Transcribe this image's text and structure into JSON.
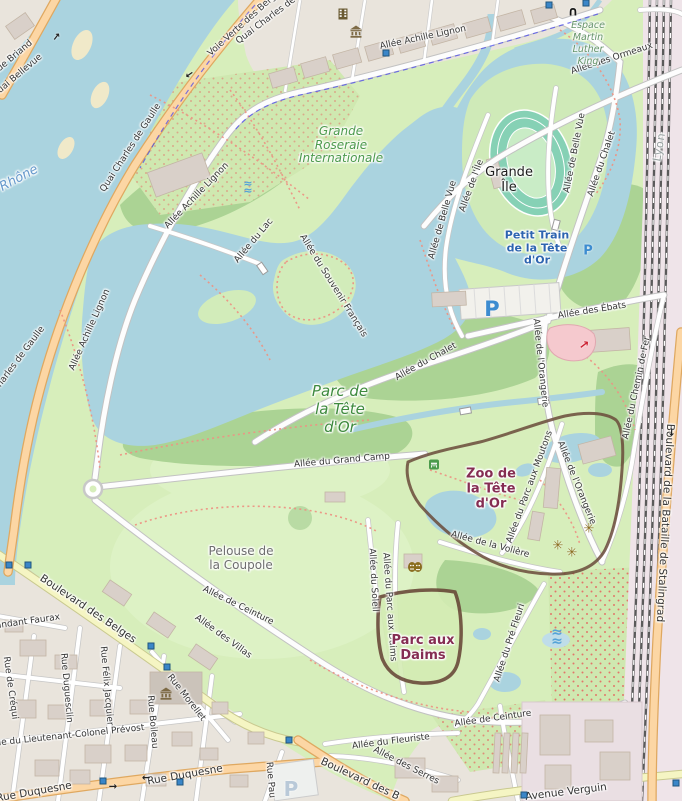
{
  "colors": {
    "water": "#aad3df",
    "park": "#d7eebb",
    "wood": "#abd394",
    "road_primary": "#fcd6a4",
    "road_secondary": "#f5f5c3",
    "urban": "#e9e4dc",
    "building": "#d9d0c9",
    "rail": "#5a5a5a",
    "zoo_border": "#6a4a3a",
    "label_green": "#4c9a4c",
    "label_maroon": "#852d52",
    "label_blue": "#2d64b0"
  },
  "labels": [
    {
      "id": "ide-briand",
      "text": "ide Briand",
      "x": 14,
      "y": 57,
      "rot": -40,
      "cls": "street"
    },
    {
      "id": "quai-bellevue",
      "text": "uai Bellevue",
      "x": 20,
      "y": 74,
      "rot": -40,
      "cls": "street"
    },
    {
      "id": "le-rhone",
      "text": "e Rhône",
      "x": 14,
      "y": 182,
      "rot": -28,
      "cls": "water-name"
    },
    {
      "id": "qcdg-top",
      "text": "Quai Charles de",
      "x": 266,
      "y": 21,
      "rot": -37,
      "cls": "street"
    },
    {
      "id": "voie-verte",
      "text": "Voie Verte des Berges",
      "x": 246,
      "y": 22,
      "rot": -42,
      "cls": "street"
    },
    {
      "id": "qcdg-mid",
      "text": "Quai Charles de Gaulle",
      "x": 131,
      "y": 148,
      "rot": -57,
      "cls": "street"
    },
    {
      "id": "qcdg-left",
      "text": "harles de Gaulle",
      "x": 21,
      "y": 357,
      "rot": -53,
      "cls": "street"
    },
    {
      "id": "aal-top",
      "text": "Allée Achille Lignon",
      "x": 423,
      "y": 38,
      "rot": -12,
      "cls": "street"
    },
    {
      "id": "aal-mid",
      "text": "Allée Achille Lignon",
      "x": 197,
      "y": 196,
      "rot": -46,
      "cls": "street"
    },
    {
      "id": "aal-low",
      "text": "Allée Achille Lignon",
      "x": 90,
      "y": 330,
      "rot": -66,
      "cls": "street"
    },
    {
      "id": "ormeaux",
      "text": "Allée des Ormeaux",
      "x": 612,
      "y": 59,
      "rot": -18,
      "cls": "street"
    },
    {
      "id": "espace-mlk",
      "text": "Espace\nMartin\nLuther\nKing",
      "x": 588,
      "y": 44,
      "rot": 0,
      "cls": "espace"
    },
    {
      "id": "roseraie",
      "text": "Grande\nRoseraie\nInternationale",
      "x": 341,
      "y": 145,
      "rot": 0,
      "cls": "park-sub"
    },
    {
      "id": "bellevue-w",
      "text": "Allée de Belle Vue",
      "x": 443,
      "y": 220,
      "rot": -74,
      "cls": "street"
    },
    {
      "id": "bellevue-e",
      "text": "Allée de Belle Vue",
      "x": 575,
      "y": 153,
      "rot": -79,
      "cls": "street"
    },
    {
      "id": "allee-ile",
      "text": "Allée de l'Île",
      "x": 472,
      "y": 186,
      "rot": -70,
      "cls": "street"
    },
    {
      "id": "grande-ile",
      "text": "Grande\nÎle",
      "x": 509,
      "y": 180,
      "rot": 0,
      "cls": "place-black"
    },
    {
      "id": "petit-train",
      "text": "Petit Train\nde la Tête\nd'Or",
      "x": 537,
      "y": 248,
      "rot": 0,
      "cls": "poi-blue"
    },
    {
      "id": "allee-lac",
      "text": "Allée du Lac",
      "x": 254,
      "y": 241,
      "rot": -50,
      "cls": "street"
    },
    {
      "id": "souvenir",
      "text": "Allée du Souvenir Français",
      "x": 333,
      "y": 286,
      "rot": 58,
      "cls": "street"
    },
    {
      "id": "ebats",
      "text": "Allée des Ébats",
      "x": 592,
      "y": 311,
      "rot": -9,
      "cls": "street"
    },
    {
      "id": "chalet-diag",
      "text": "Allée du Chalet",
      "x": 426,
      "y": 362,
      "rot": -29,
      "cls": "street"
    },
    {
      "id": "chalet-vert",
      "text": "Allée du Chalet",
      "x": 602,
      "y": 164,
      "rot": -71,
      "cls": "street"
    },
    {
      "id": "orangerie-n",
      "text": "Allée de l'Orangerie",
      "x": 540,
      "y": 363,
      "rot": 84,
      "cls": "street"
    },
    {
      "id": "orangerie-s",
      "text": "Allée de l'Orangerie",
      "x": 576,
      "y": 483,
      "rot": 68,
      "cls": "street"
    },
    {
      "id": "chemin-fer",
      "text": "Allée du Chemin de Fer",
      "x": 637,
      "y": 388,
      "rot": -78,
      "cls": "street"
    },
    {
      "id": "lyon",
      "text": "Lyon",
      "x": 660,
      "y": 147,
      "rot": -80,
      "cls": "city-gray"
    },
    {
      "id": "stalingrad",
      "text": "Boulevard de la Bataille de Stalingrad",
      "x": 665,
      "y": 523,
      "rot": 93,
      "cls": "street-lg"
    },
    {
      "id": "parc-tete",
      "text": "Parc de\nla Tête\nd'Or",
      "x": 340,
      "y": 409,
      "rot": 0,
      "cls": "park-name"
    },
    {
      "id": "grand-camp",
      "text": "Allée du Grand Camp",
      "x": 342,
      "y": 461,
      "rot": -5,
      "cls": "street"
    },
    {
      "id": "zoo",
      "text": "Zoo de\nla Tête\nd'Or",
      "x": 491,
      "y": 489,
      "rot": 0,
      "cls": "poi-maroon"
    },
    {
      "id": "moutons",
      "text": "Allée du Parc aux Moutons",
      "x": 530,
      "y": 487,
      "rot": -70,
      "cls": "street"
    },
    {
      "id": "voliere",
      "text": "Allée de la Volière",
      "x": 490,
      "y": 545,
      "rot": 15,
      "cls": "street"
    },
    {
      "id": "soleil",
      "text": "Allée du Soleil",
      "x": 373,
      "y": 580,
      "rot": 87,
      "cls": "street"
    },
    {
      "id": "daims-allee",
      "text": "Allée du Parc aux Daims",
      "x": 389,
      "y": 607,
      "rot": 86,
      "cls": "street"
    },
    {
      "id": "pre-fleuri",
      "text": "Allée du Pré Fleuri",
      "x": 510,
      "y": 643,
      "rot": -72,
      "cls": "street"
    },
    {
      "id": "pelouse",
      "text": "Pelouse de\nla Coupole",
      "x": 241,
      "y": 558,
      "rot": 0,
      "cls": "poi-gray"
    },
    {
      "id": "ceinture-1",
      "text": "Allée de Ceinture",
      "x": 238,
      "y": 606,
      "rot": 26,
      "cls": "street"
    },
    {
      "id": "villas",
      "text": "Allée des Villas",
      "x": 223,
      "y": 637,
      "rot": 36,
      "cls": "street"
    },
    {
      "id": "belges",
      "text": "Boulevard des Belges",
      "x": 88,
      "y": 609,
      "rot": 34,
      "cls": "street-lg"
    },
    {
      "id": "faurax",
      "text": "andant Faurax",
      "x": 28,
      "y": 622,
      "rot": -8,
      "cls": "street"
    },
    {
      "id": "crequi",
      "text": "Rue de Créqui",
      "x": 10,
      "y": 688,
      "rot": 82,
      "cls": "street"
    },
    {
      "id": "duguesclin",
      "text": "Rue Duguesclin",
      "x": 66,
      "y": 688,
      "rot": 85,
      "cls": "street"
    },
    {
      "id": "jacquier",
      "text": "Rue Félix Jacquier",
      "x": 106,
      "y": 686,
      "rot": 85,
      "cls": "street"
    },
    {
      "id": "boileau",
      "text": "Rue Boileau",
      "x": 152,
      "y": 722,
      "rot": 85,
      "cls": "street"
    },
    {
      "id": "morellet",
      "text": "Rue Morellet",
      "x": 186,
      "y": 698,
      "rot": 52,
      "cls": "street"
    },
    {
      "id": "prevost",
      "text": "ue du Lieutenant-Colonel Prévost",
      "x": 70,
      "y": 736,
      "rot": -6,
      "cls": "street"
    },
    {
      "id": "duquesne-l",
      "text": "Rue Duquesne",
      "x": 34,
      "y": 792,
      "rot": -10,
      "cls": "street-lg"
    },
    {
      "id": "duquesne-r",
      "text": "Rue Duquesne",
      "x": 185,
      "y": 775,
      "rot": -10,
      "cls": "street-lg"
    },
    {
      "id": "rue-pau",
      "text": "Rue Pau",
      "x": 270,
      "y": 780,
      "rot": 85,
      "cls": "street"
    },
    {
      "id": "belges-s",
      "text": "Boulevard des B",
      "x": 360,
      "y": 779,
      "rot": 25,
      "cls": "street-lg"
    },
    {
      "id": "fleuriste",
      "text": "Allée du Fleuriste",
      "x": 391,
      "y": 742,
      "rot": -7,
      "cls": "street"
    },
    {
      "id": "serres",
      "text": "Allée des Serres",
      "x": 406,
      "y": 766,
      "rot": 27,
      "cls": "street"
    },
    {
      "id": "ceinture-2",
      "text": "Allée de Ceinture",
      "x": 493,
      "y": 719,
      "rot": -8,
      "cls": "street"
    },
    {
      "id": "verguin",
      "text": "Avenue Verguin",
      "x": 566,
      "y": 792,
      "rot": -7,
      "cls": "street-lg"
    },
    {
      "id": "parc-daims",
      "text": "Parc aux\nDaims",
      "x": 423,
      "y": 648,
      "rot": 0,
      "cls": "poi-maroon"
    }
  ],
  "icons": [
    {
      "id": "cinema-icon",
      "type": "cinema",
      "x": 343,
      "y": 15
    },
    {
      "id": "museum-icon-cite",
      "type": "museum",
      "x": 356,
      "y": 33
    },
    {
      "id": "museum-icon-city",
      "type": "museum",
      "x": 166,
      "y": 695
    },
    {
      "id": "theatre-masks-icon",
      "type": "masks",
      "x": 415,
      "y": 567
    },
    {
      "id": "fountain-icon-lake",
      "type": "waves",
      "x": 248,
      "y": 188,
      "size": 11
    },
    {
      "id": "fountain-icon-garden",
      "type": "waves",
      "x": 557,
      "y": 637,
      "size": 14
    },
    {
      "id": "arch-icon",
      "type": "text",
      "glyph": "∩",
      "x": 573,
      "y": 12,
      "color": "#161616",
      "size": 13
    },
    {
      "id": "slide-arrow-icon",
      "type": "text",
      "glyph": "↗",
      "x": 584,
      "y": 345,
      "color": "#cc2233",
      "size": 12,
      "rot": 8
    },
    {
      "id": "flower-icon-1",
      "type": "text",
      "glyph": "✳",
      "x": 558,
      "y": 546,
      "color": "#8a6d1f",
      "size": 13
    },
    {
      "id": "flower-icon-2",
      "type": "text",
      "glyph": "✳",
      "x": 572,
      "y": 553,
      "color": "#8a6d1f",
      "size": 13
    },
    {
      "id": "flower-icon-3",
      "type": "text",
      "glyph": "✳",
      "x": 589,
      "y": 529,
      "color": "#8a6d1f",
      "size": 13
    },
    {
      "id": "parking-p-main",
      "type": "parking",
      "glyph": "P",
      "x": 492,
      "y": 309,
      "size": 21,
      "color": "#3d8cd0"
    },
    {
      "id": "parking-p-small",
      "type": "parking",
      "glyph": "P",
      "x": 588,
      "y": 251,
      "size": 13,
      "color": "#3d8cd0"
    },
    {
      "id": "parking-p-pale",
      "type": "parking",
      "glyph": "P",
      "x": 291,
      "y": 789,
      "size": 20,
      "color": "#b9c9d8"
    },
    {
      "id": "picnic-icon",
      "type": "picnic",
      "x": 434,
      "y": 464
    },
    {
      "id": "transit-stop-1",
      "type": "stop",
      "x": 386,
      "y": 53
    },
    {
      "id": "transit-stop-2",
      "type": "stop",
      "x": 549,
      "y": 5
    },
    {
      "id": "transit-stop-3",
      "type": "stop",
      "x": 586,
      "y": 3
    },
    {
      "id": "transit-stop-4",
      "type": "stop",
      "x": 9,
      "y": 565
    },
    {
      "id": "transit-stop-5",
      "type": "stop",
      "x": 28,
      "y": 565
    },
    {
      "id": "transit-stop-6",
      "type": "stop",
      "x": 151,
      "y": 646
    },
    {
      "id": "transit-stop-7",
      "type": "stop",
      "x": 167,
      "y": 667
    },
    {
      "id": "transit-stop-8",
      "type": "stop",
      "x": 103,
      "y": 781
    },
    {
      "id": "transit-stop-9",
      "type": "stop",
      "x": 180,
      "y": 782
    },
    {
      "id": "transit-stop-10",
      "type": "stop",
      "x": 289,
      "y": 740
    },
    {
      "id": "transit-stop-11",
      "type": "stop",
      "x": 524,
      "y": 795
    },
    {
      "id": "transit-stop-12",
      "type": "stop",
      "x": 676,
      "y": 783
    },
    {
      "id": "oneway-arrow-1",
      "type": "text",
      "glyph": "→",
      "x": 57,
      "y": 37,
      "color": "#222",
      "size": 10,
      "rot": -52
    },
    {
      "id": "oneway-arrow-2",
      "type": "text",
      "glyph": "→",
      "x": 189,
      "y": 74,
      "color": "#222",
      "size": 10,
      "rot": 145
    },
    {
      "id": "oneway-arrow-3",
      "type": "text",
      "glyph": "→",
      "x": 671,
      "y": 432,
      "color": "#222",
      "size": 10,
      "rot": 92
    },
    {
      "id": "oneway-arrow-4",
      "type": "text",
      "glyph": "→",
      "x": 146,
      "y": 777,
      "color": "#222",
      "size": 10,
      "rot": 180
    },
    {
      "id": "oneway-arrow-5",
      "type": "text",
      "glyph": "→",
      "x": 113,
      "y": 787,
      "color": "#222",
      "size": 10,
      "rot": 0
    }
  ]
}
